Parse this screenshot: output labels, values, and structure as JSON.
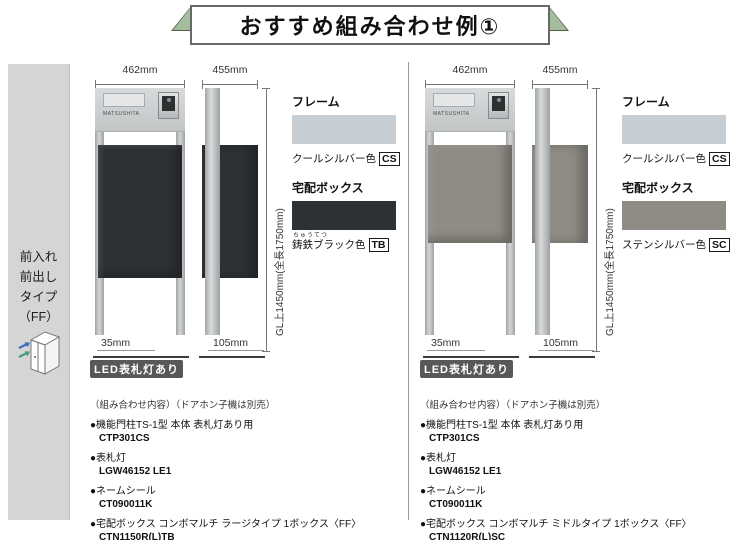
{
  "banner": {
    "title": "おすすめ組み合わせ例①"
  },
  "sidebar": {
    "lines": [
      "前入れ",
      "前出し",
      "タイプ",
      "（FF）"
    ],
    "arrow_colors": {
      "in": "#3a6fc4",
      "out": "#3f9d78"
    }
  },
  "panels": [
    {
      "front_width": "462mm",
      "side_depth": "455mm",
      "height_label": "GL上1450mm(全長1750mm)",
      "front_offset": "35mm",
      "side_offset": "105mm",
      "nameplate": "MATSUSHITA",
      "led_badge": "LED表札灯あり",
      "frame": {
        "label": "フレーム",
        "color_name": "クールシルバー色",
        "code": "CS",
        "swatch": "#c7ced3"
      },
      "box": {
        "label": "宅配ボックス",
        "furigana": "ちゅうてつ",
        "color_name": "鋳鉄ブラック色",
        "code": "TB",
        "swatch": "#2d3034"
      },
      "list_header": "（組み合わせ内容）（ドアホン子機は別売）",
      "items": [
        {
          "label": "●機能門柱TS-1型 本体 表札灯あり用",
          "code": "CTP301CS"
        },
        {
          "label": "●表札灯",
          "code": "LGW46152 LE1"
        },
        {
          "label": "●ネームシール",
          "code": "CT090011K"
        },
        {
          "label": "●宅配ボックス コンボマルチ ラージタイプ 1ボックス〈FF〉",
          "code": "CTN1150R(L)TB"
        }
      ]
    },
    {
      "front_width": "462mm",
      "side_depth": "455mm",
      "height_label": "GL上1450mm(全長1750mm)",
      "front_offset": "35mm",
      "side_offset": "105mm",
      "nameplate": "MATSUSHITA",
      "led_badge": "LED表札灯あり",
      "frame": {
        "label": "フレーム",
        "color_name": "クールシルバー色",
        "code": "CS",
        "swatch": "#c7ced3"
      },
      "box": {
        "label": "宅配ボックス",
        "furigana": "",
        "color_name": "ステンシルバー色",
        "code": "SC",
        "swatch": "#8f8c85"
      },
      "list_header": "（組み合わせ内容）（ドアホン子機は別売）",
      "items": [
        {
          "label": "●機能門柱TS-1型 本体 表札灯あり用",
          "code": "CTP301CS"
        },
        {
          "label": "●表札灯",
          "code": "LGW46152 LE1"
        },
        {
          "label": "●ネームシール",
          "code": "CT090011K"
        },
        {
          "label": "●宅配ボックス コンボマルチ ミドルタイプ 1ボックス〈FF〉",
          "code": "CTN1120R(L)SC"
        }
      ]
    }
  ]
}
